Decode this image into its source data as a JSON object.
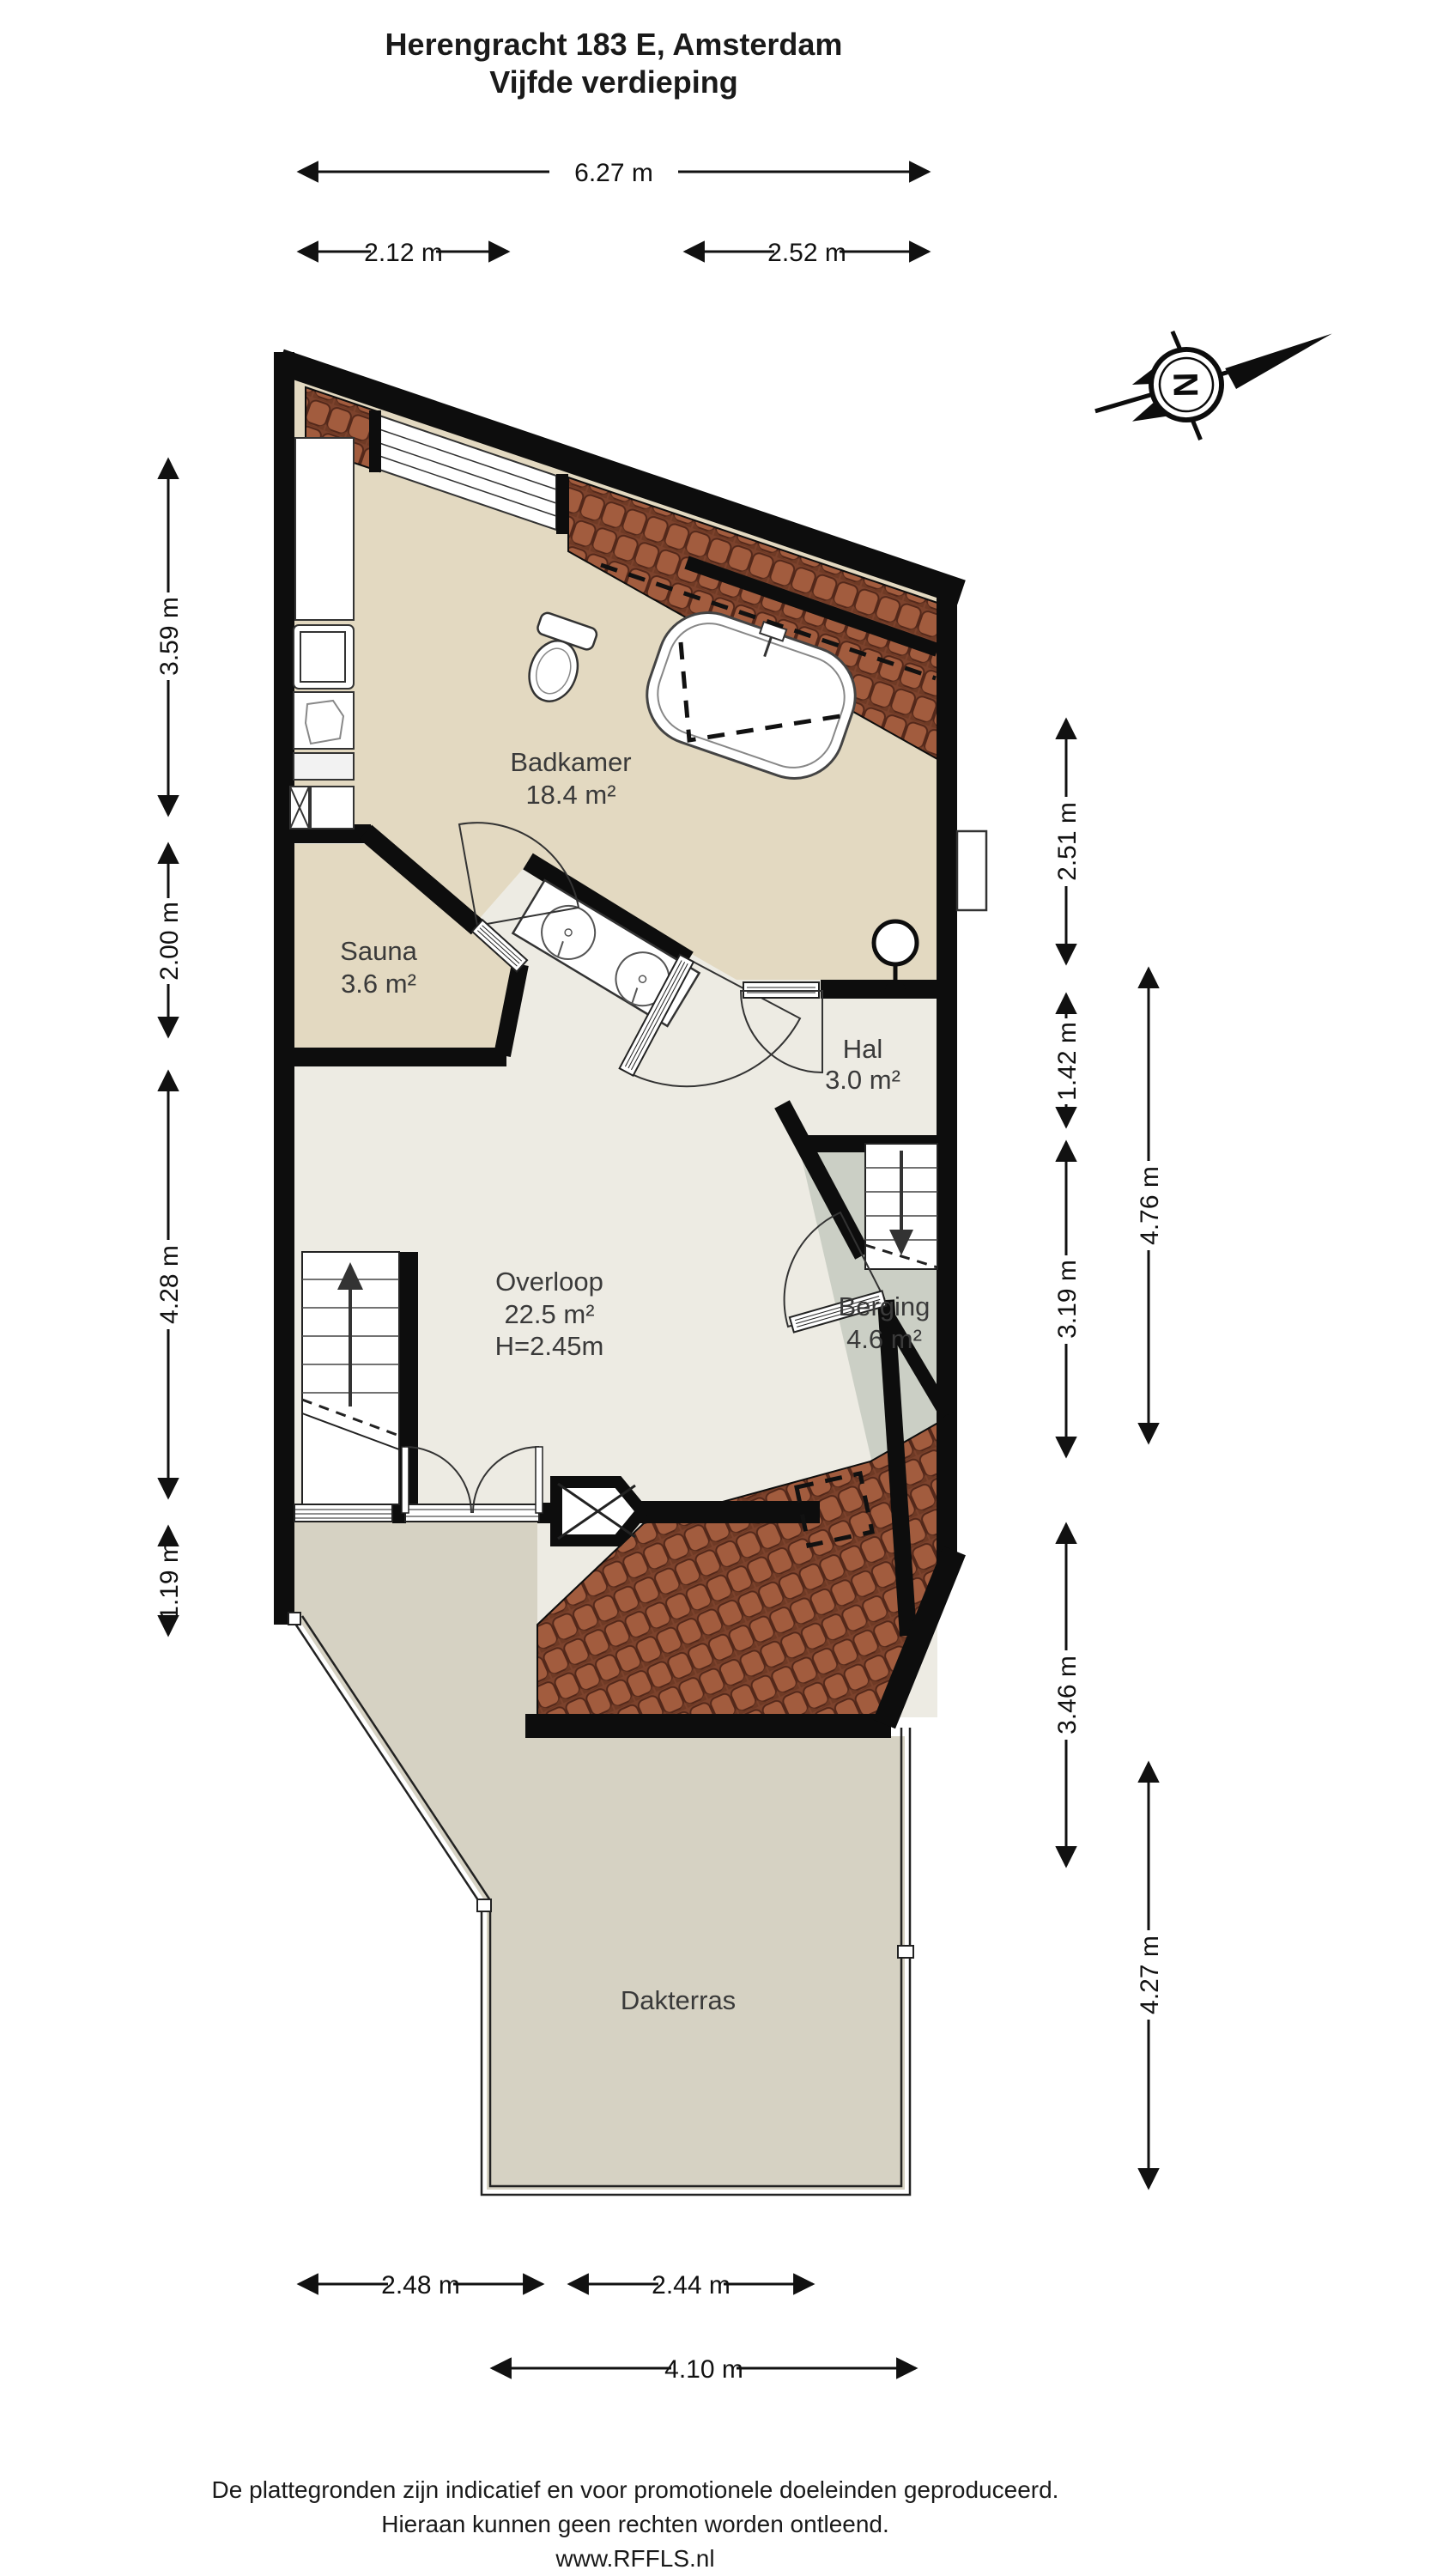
{
  "title": {
    "line1": "Herengracht 183 E, Amsterdam",
    "line2": "Vijfde verdieping"
  },
  "compass": {
    "letter": "N"
  },
  "rooms": {
    "badkamer": {
      "name": "Badkamer",
      "area": "18.4 m²"
    },
    "sauna": {
      "name": "Sauna",
      "area": "3.6 m²"
    },
    "hal": {
      "name": "Hal",
      "area": "3.0 m²"
    },
    "overloop": {
      "name": "Overloop",
      "area": "22.5 m²",
      "height": "H=2.45m"
    },
    "berging": {
      "name": "Berging",
      "area": "4.6 m²"
    },
    "dakterras": {
      "name": "Dakterras"
    }
  },
  "dimensions": {
    "top": [
      {
        "label": "6.27 m"
      },
      {
        "label": "2.12 m"
      },
      {
        "label": "2.52 m"
      }
    ],
    "bottom": [
      {
        "label": "2.48 m"
      },
      {
        "label": "2.44 m"
      },
      {
        "label": "4.10 m"
      }
    ],
    "left": [
      {
        "label": "3.59 m"
      },
      {
        "label": "2.00 m"
      },
      {
        "label": "4.28 m"
      },
      {
        "label": "1.19 m"
      }
    ],
    "right_inner": [
      {
        "label": "2.51 m"
      },
      {
        "label": "1.42 m"
      },
      {
        "label": "3.19 m"
      },
      {
        "label": "3.46 m"
      }
    ],
    "right_outer": [
      {
        "label": "4.76 m"
      },
      {
        "label": "4.27 m"
      }
    ]
  },
  "footer": {
    "line1": "De plattegronden zijn indicatief en voor promotionele doeleinden geproduceerd.",
    "line2": "Hieraan kunnen geen rechten worden ontleend.",
    "line3": "www.RFFLS.nl"
  },
  "colors": {
    "wall": "#0d0d0d",
    "badkamer_floor": "#e3d9c1",
    "overloop_floor": "#edebe3",
    "berging_floor": "#cbcfc5",
    "terrace_floor": "#d6d2c3",
    "roof_tile": "#a25c3e"
  }
}
